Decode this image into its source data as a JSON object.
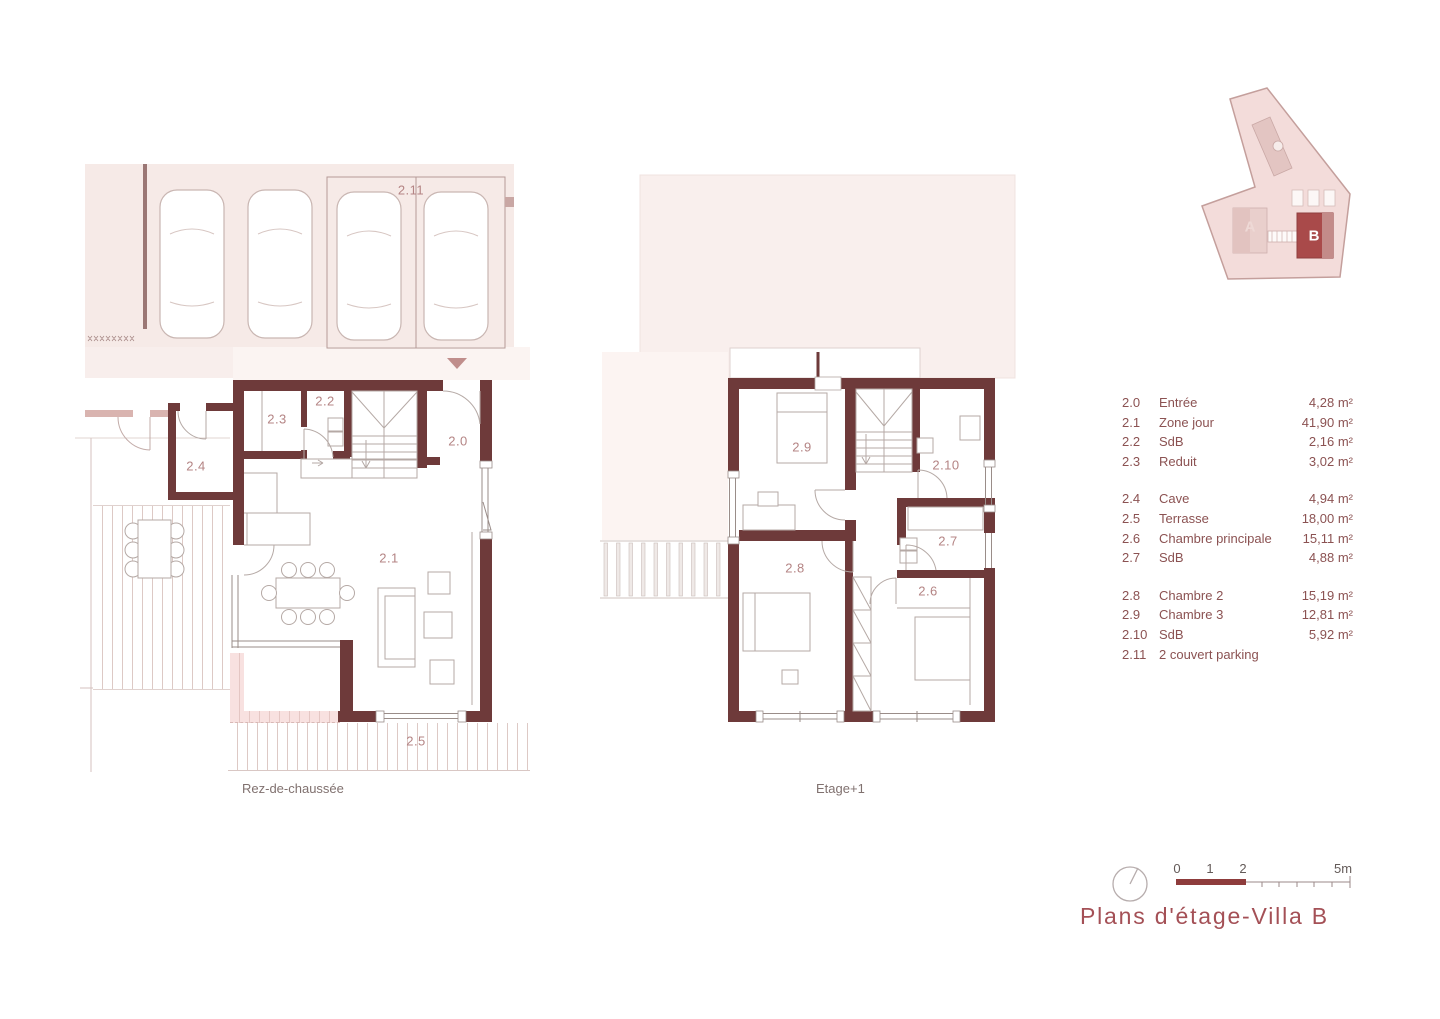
{
  "title": "Plans d'étage-Villa B",
  "colors": {
    "wall": "#6e3a3a",
    "accent_title": "#a45056",
    "legend_text": "#8b5252",
    "room_label": "#b48484",
    "building_b_fill": "#a94a4a",
    "scale_bar": "#8e3c3c"
  },
  "site_key": {
    "label_a": "A",
    "label_b": "B"
  },
  "plans": {
    "ground": {
      "caption": "Rez-de-chaussée",
      "room_labels": [
        {
          "id": "2.11"
        },
        {
          "id": "2.3"
        },
        {
          "id": "2.2"
        },
        {
          "id": "2.0"
        },
        {
          "id": "2.4"
        },
        {
          "id": "2.1"
        },
        {
          "id": "2.5"
        }
      ]
    },
    "upper": {
      "caption": "Etage+1",
      "room_labels": [
        {
          "id": "2.9"
        },
        {
          "id": "2.10"
        },
        {
          "id": "2.7"
        },
        {
          "id": "2.8"
        },
        {
          "id": "2.6"
        }
      ]
    }
  },
  "legend": {
    "groups": [
      {
        "rows": [
          {
            "num": "2.0",
            "name": "Entrée",
            "area": "4,28 m²"
          },
          {
            "num": "2.1",
            "name": "Zone jour",
            "area": "41,90 m²"
          },
          {
            "num": "2.2",
            "name": "SdB",
            "area": "2,16 m²"
          },
          {
            "num": "2.3",
            "name": "Reduit",
            "area": "3,02 m²"
          }
        ]
      },
      {
        "rows": [
          {
            "num": "2.4",
            "name": "Cave",
            "area": "4,94 m²"
          },
          {
            "num": "2.5",
            "name": "Terrasse",
            "area": "18,00 m²"
          },
          {
            "num": "2.6",
            "name": "Chambre principale",
            "area": "15,11 m²"
          },
          {
            "num": "2.7",
            "name": "SdB",
            "area": "4,88 m²"
          }
        ]
      },
      {
        "rows": [
          {
            "num": "2.8",
            "name": "Chambre 2",
            "area": "15,19 m²"
          },
          {
            "num": "2.9",
            "name": "Chambre 3",
            "area": "12,81 m²"
          },
          {
            "num": "2.10",
            "name": "SdB",
            "area": "5,92 m²"
          },
          {
            "num": "2.11",
            "name": "2 couvert parking",
            "area": ""
          }
        ]
      }
    ]
  },
  "scale_bar": {
    "labels": [
      "0",
      "1",
      "2",
      "5m"
    ]
  }
}
